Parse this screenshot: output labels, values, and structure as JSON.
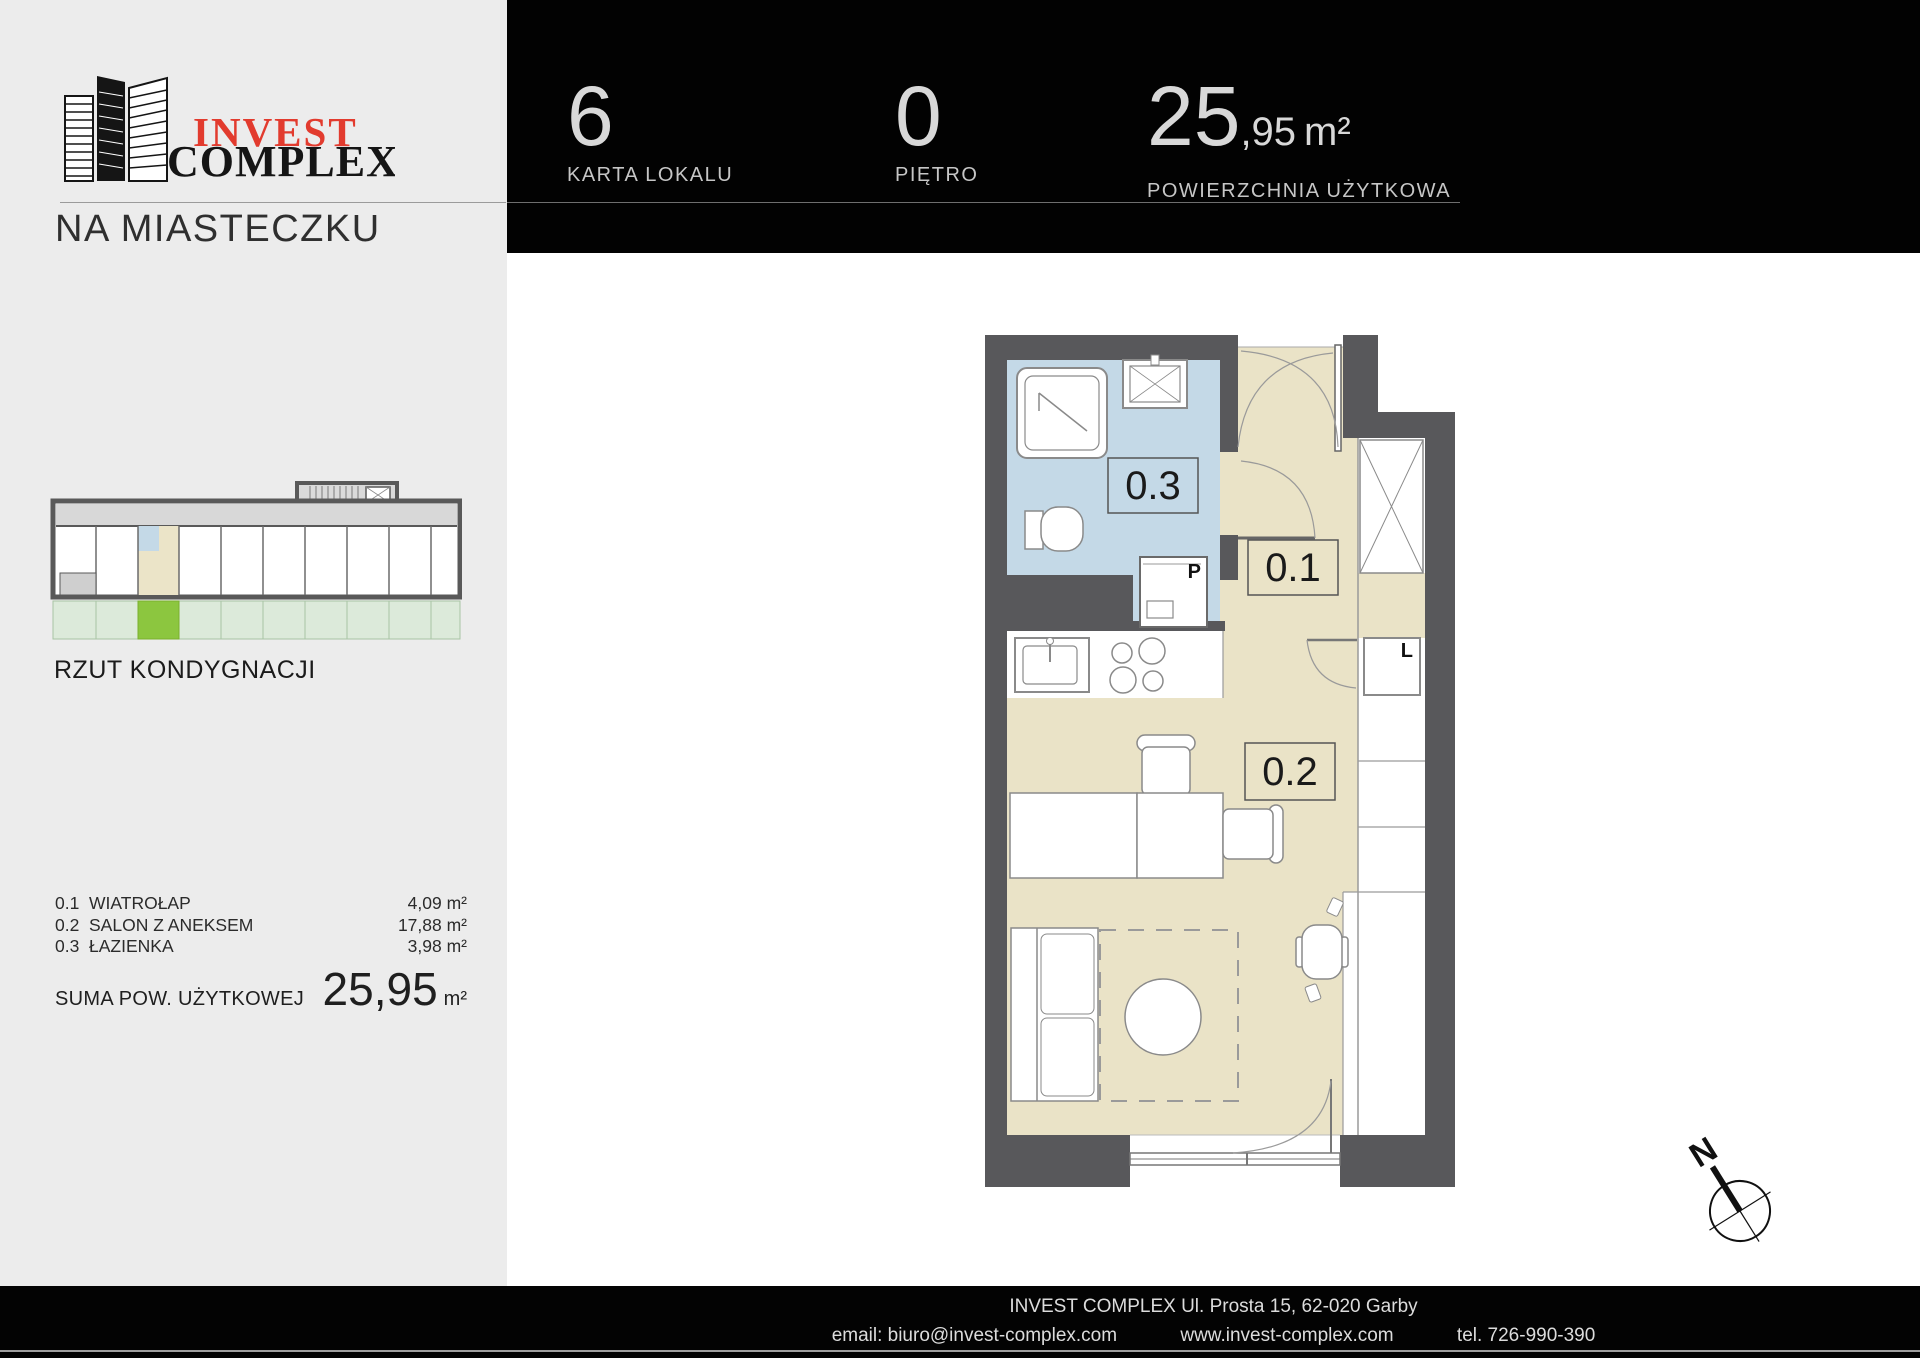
{
  "logo": {
    "invest": "INVEST",
    "complex": "COMPLEX",
    "subtitle": "NA MIASTECZKU"
  },
  "overview": {
    "label": "RZUT KONDYGNACJI"
  },
  "rooms": [
    {
      "no": "0.1",
      "name": "WIATROŁAP",
      "area": "4,09 m²"
    },
    {
      "no": "0.2",
      "name": "SALON Z ANEKSEM",
      "area": "17,88 m²"
    },
    {
      "no": "0.3",
      "name": "ŁAZIENKA",
      "area": "3,98 m²"
    }
  ],
  "sum": {
    "label": "SUMA POW. UŻYTKOWEJ",
    "value": "25,95",
    "unit": "m²"
  },
  "header": {
    "unit": {
      "value": "6",
      "label": "KARTA LOKALU"
    },
    "floor": {
      "value": "0",
      "label": "PIĘTRO"
    },
    "area": {
      "int": "25",
      "frac": ",95",
      "unit": "m²",
      "label": "POWIERZCHNIA UŻYTKOWA"
    }
  },
  "plan": {
    "labels": {
      "hall": "0.1",
      "salon": "0.2",
      "bath": "0.3",
      "washer": "P",
      "fridge": "L"
    }
  },
  "compass": {
    "n": "N"
  },
  "footer": {
    "address": "INVEST COMPLEX Ul. Prosta 15, 62-020 Garby",
    "email": "email: biuro@invest-complex.com",
    "www": "www.invest-complex.com",
    "tel": "tel. 726-990-390"
  },
  "colors": {
    "accent_red": "#E23B2E",
    "sidebar_bg": "#ECECEC",
    "header_bg": "#020202",
    "wall_gray": "#58585B",
    "room_beige": "#EAE3C7",
    "bath_blue": "#C4D9E7",
    "garden_green": "#DCEADA",
    "highlight_green": "#8CC63F"
  }
}
